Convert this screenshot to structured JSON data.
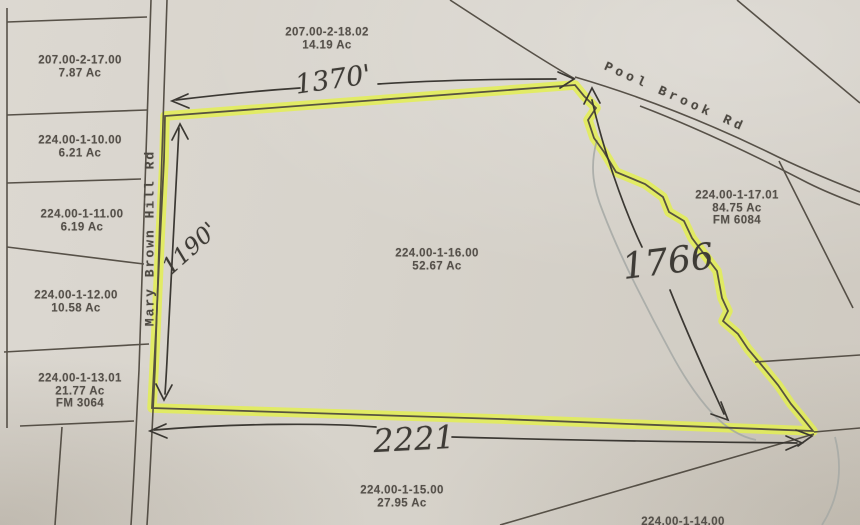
{
  "map": {
    "description": "Tax parcel map with parcel 224.00-1-16.00 outlined in yellow highlighter and handwritten boundary dimensions",
    "highlight_color": "#e3ef52",
    "line_color": "#4c463d",
    "stream_color": "#a4a8a4",
    "ink_color": "#3b3833",
    "parcels": [
      {
        "id": "207.00-2-17.00",
        "acreage": "7.87 Ac"
      },
      {
        "id": "224.00-1-10.00",
        "acreage": "6.21 Ac"
      },
      {
        "id": "224.00-1-11.00",
        "acreage": "6.19 Ac"
      },
      {
        "id": "224.00-1-12.00",
        "acreage": "10.58 Ac"
      },
      {
        "id": "224.00-1-13.01",
        "acreage": "21.77 Ac",
        "fm": "FM 3064"
      },
      {
        "id": "207.00-2-18.02",
        "acreage": "14.19 Ac"
      },
      {
        "id": "224.00-1-16.00",
        "acreage": "52.67 Ac"
      },
      {
        "id": "224.00-1-17.01",
        "acreage": "84.75 Ac",
        "fm": "FM 6084"
      },
      {
        "id": "224.00-1-15.00",
        "acreage": "27.95 Ac"
      },
      {
        "id": "224.00-1-14.00",
        "acreage": ""
      }
    ],
    "roads": {
      "mary_brown_hill": "Mary Brown Hill Rd",
      "pool_brook": "Pool Brook Rd"
    },
    "dimensions": {
      "north": "1370'",
      "west": "1190'",
      "east": "1766",
      "south": "2221"
    }
  }
}
